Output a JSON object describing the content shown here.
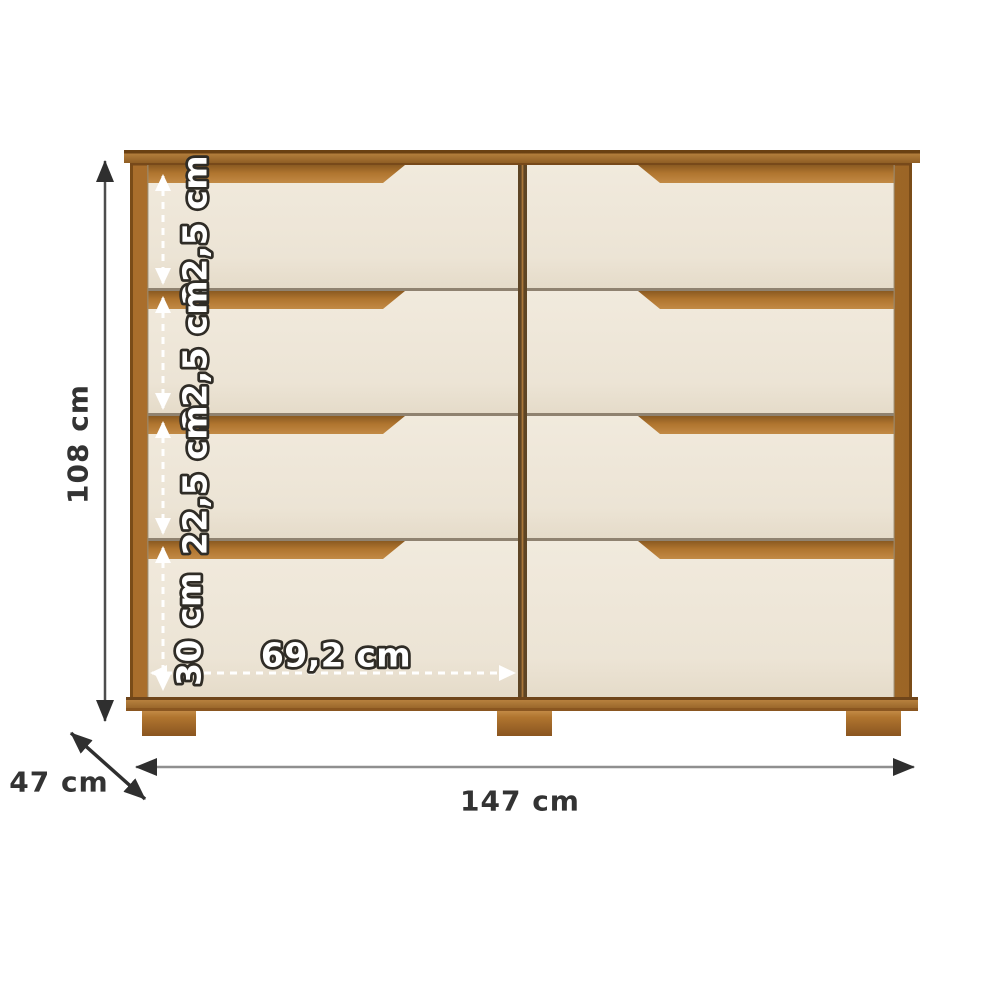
{
  "diagram": {
    "kind": "furniture-dimension-diagram",
    "dimensions": {
      "height": "108 cm",
      "width": "147 cm",
      "depth": "47 cm",
      "drawer_width": "69,2 cm",
      "rows": [
        "22,5 cm",
        "22,5 cm",
        "22,5 cm",
        "30 cm"
      ]
    },
    "colors": {
      "background": "#ffffff",
      "wood": "#b0752f",
      "wood_light": "#c28a45",
      "wood_dark": "#8f5e24",
      "wood_outline": "#6a4012",
      "divider": "#5e4525",
      "drawer_front": "#f1eadd",
      "drawer_front_shade": "#e5dbc9",
      "gap_line": "#8f8270",
      "arrow_black": "#2f2f2f",
      "arrow_line_dark": "#4d4d4d",
      "arrow_line_gray": "#8f8f8f",
      "dim_text_dark": "#333333",
      "dim_text_light": "#ffffff",
      "dim_text_outline": "#2f2c26"
    }
  }
}
